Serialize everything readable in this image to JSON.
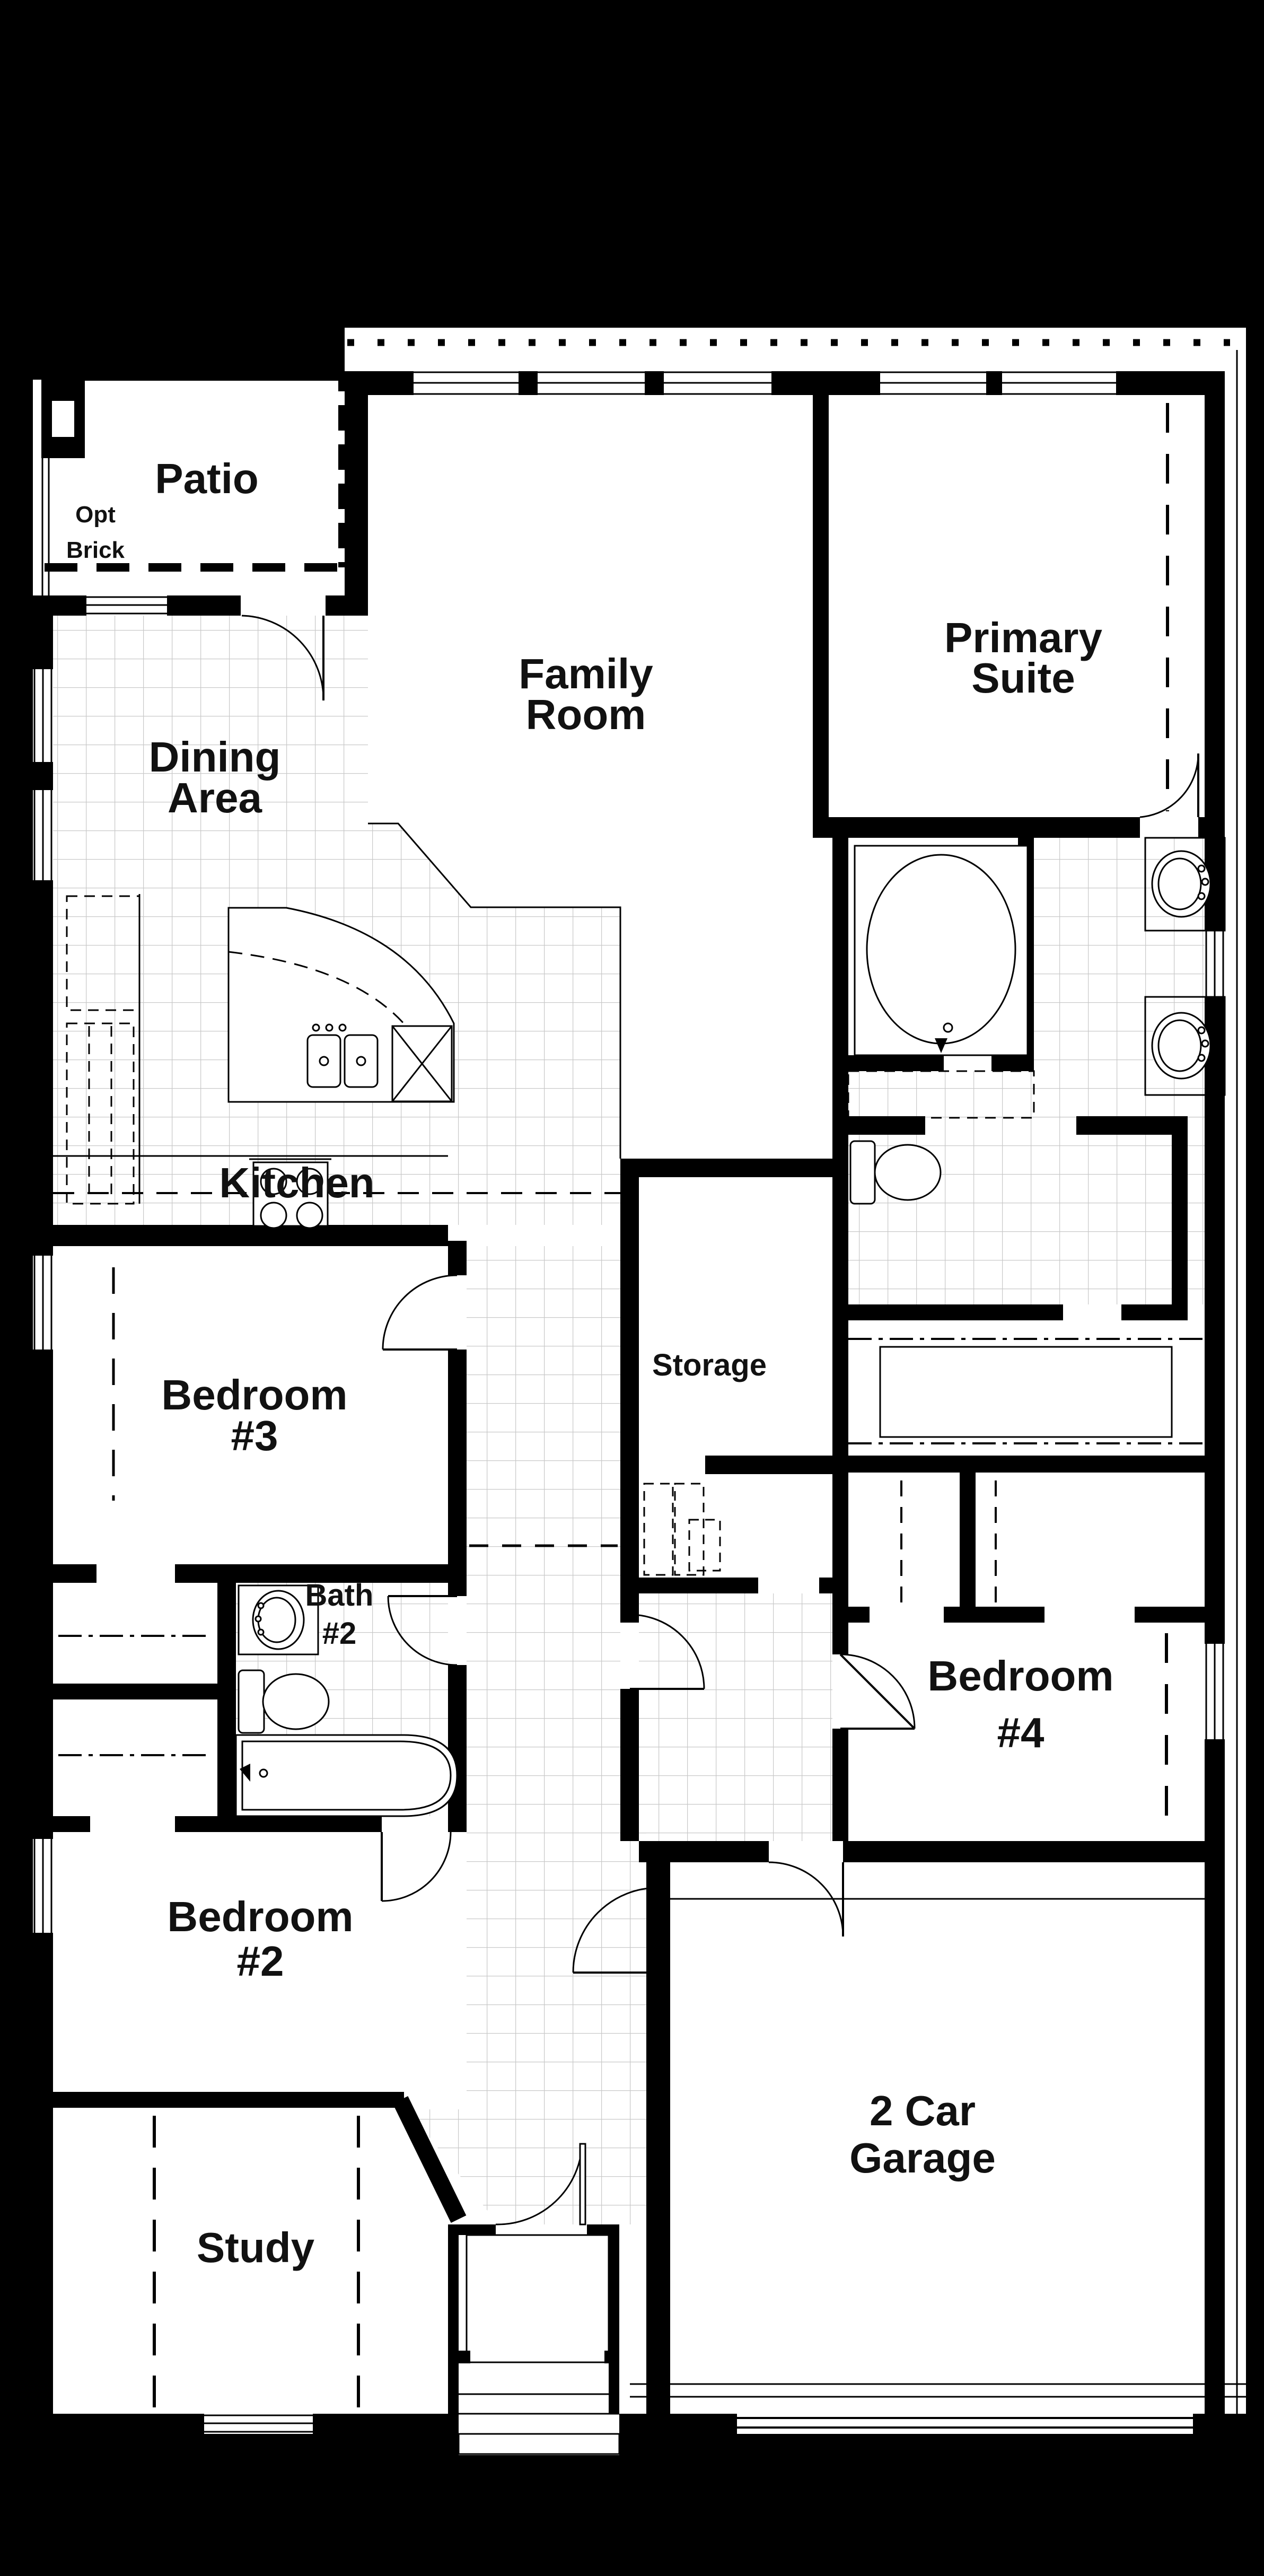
{
  "plan": {
    "title": "Single story floor plan",
    "labels": {
      "patio": "Patio",
      "opt1": "Opt",
      "opt2": "Brick",
      "dining1": "Dining",
      "dining2": "Area",
      "family1": "Family",
      "family2": "Room",
      "primary1": "Primary",
      "primary2": "Suite",
      "kitchen": "Kitchen",
      "storage": "Storage",
      "bed3a": "Bedroom",
      "bed3b": "#3",
      "bath2a": "Bath",
      "bath2b": "#2",
      "bed4a": "Bedroom",
      "bed4b": "#4",
      "bed2a": "Bedroom",
      "bed2b": "#2",
      "study": "Study",
      "garage1": "2 Car",
      "garage2": "Garage"
    },
    "colors": {
      "background": "#000000",
      "floor": "#ffffff",
      "walls": "#000000",
      "tile_grid": "#c9c9c9",
      "text": "#111111"
    }
  }
}
